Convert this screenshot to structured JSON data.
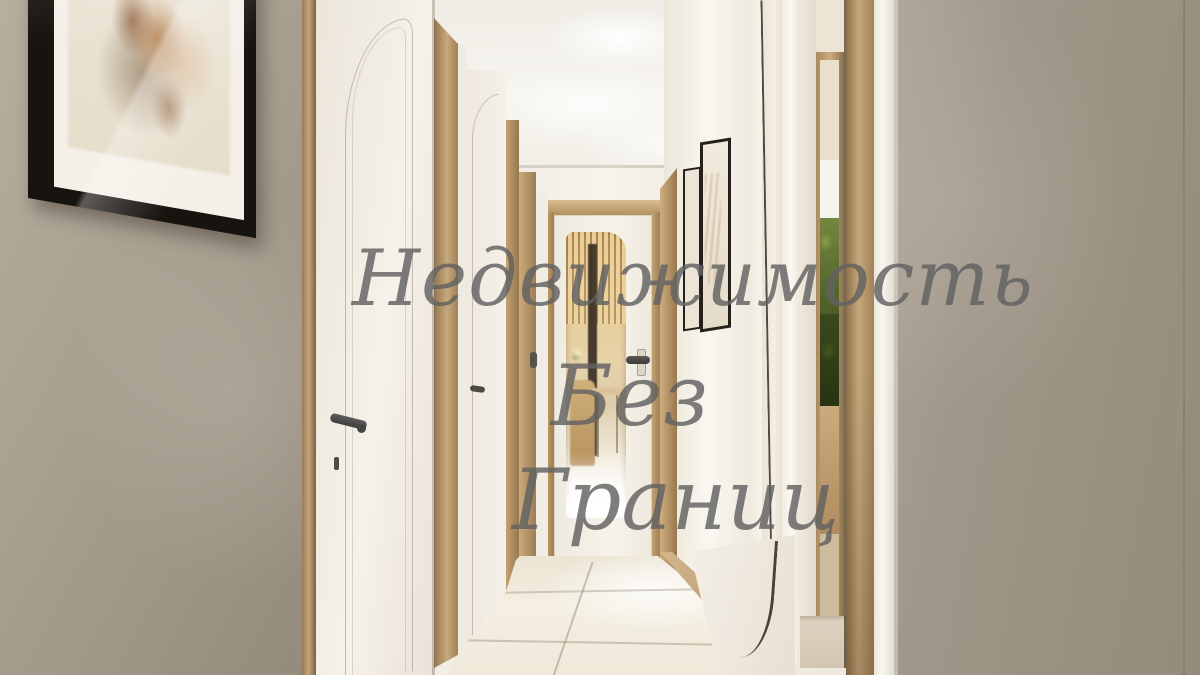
{
  "image": {
    "kind": "3D interior render photograph",
    "subject": "Narrow apartment hallway with white panelled doors, oak trim, a glazed door at the end, mirrored wardrobe on the right, black-framed dried-flower artwork on the left wall and a glossy cream tile floor"
  },
  "watermark": {
    "line1": "Недвижимость",
    "line2": "Без",
    "line3": "Границ",
    "full_text": "Недвижимость Без Границ",
    "color": "#5c5c5c"
  },
  "palette": {
    "left_wall": "#a89e90",
    "right_wall": "#9a9182",
    "hall_wall_white": "#f5f1e9",
    "door_white": "#f2ece3",
    "wood_trim": "#bd9e72",
    "ceiling": "#f5f2ec",
    "floor_tile": "#efe8d9",
    "artwork_frame": "#1b1815",
    "mirror_bezel": "#2c2822",
    "greenery_reflection": "#55682f",
    "doorway_glow": "#e2c892"
  }
}
